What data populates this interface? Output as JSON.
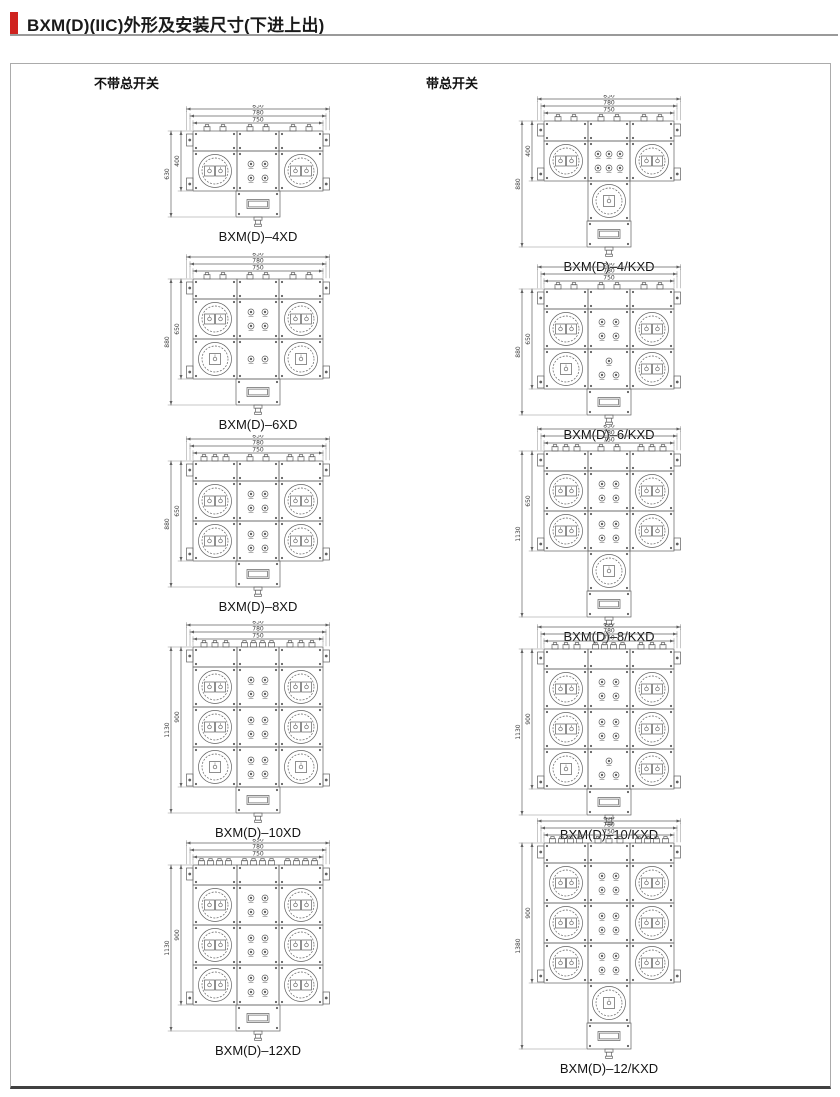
{
  "page": {
    "title": "BXM(D)(IIC)外形及安装尺寸(下进上出)",
    "accent_color": "#cf231f"
  },
  "sections": {
    "left_header": "不带总开关",
    "right_header": "带总开关"
  },
  "figures": [
    {
      "caption": "BXM(D)–4XD",
      "dimensions": {
        "top": [
          "830",
          "780",
          "750"
        ],
        "outer": "630",
        "inner": "400"
      },
      "drawing": {
        "rows": [
          {
            "left_sockets": 2,
            "indicators": 4,
            "right_sockets": 2
          }
        ],
        "has_main_switch": false,
        "glands": [
          2,
          2,
          2
        ]
      }
    },
    {
      "caption": "BXM(D)–6XD",
      "dimensions": {
        "top": [
          "830",
          "780",
          "750"
        ],
        "outer": "880",
        "inner": "650"
      },
      "drawing": {
        "rows": [
          {
            "left_sockets": 2,
            "indicators": 4,
            "right_sockets": 2
          },
          {
            "left_sockets": 1,
            "indicators": 2,
            "right_sockets": 1
          }
        ],
        "has_main_switch": false,
        "glands": [
          2,
          2,
          2
        ]
      }
    },
    {
      "caption": "BXM(D)–8XD",
      "dimensions": {
        "top": [
          "830",
          "780",
          "750"
        ],
        "outer": "880",
        "inner": "650"
      },
      "drawing": {
        "rows": [
          {
            "left_sockets": 2,
            "indicators": 4,
            "right_sockets": 2
          },
          {
            "left_sockets": 2,
            "indicators": 4,
            "right_sockets": 2
          }
        ],
        "has_main_switch": false,
        "glands": [
          3,
          2,
          3
        ]
      }
    },
    {
      "caption": "BXM(D)–10XD",
      "dimensions": {
        "top": [
          "830",
          "780",
          "750"
        ],
        "outer": "1130",
        "inner": "900"
      },
      "drawing": {
        "rows": [
          {
            "left_sockets": 2,
            "indicators": 4,
            "right_sockets": 2
          },
          {
            "left_sockets": 2,
            "indicators": 4,
            "right_sockets": 2
          },
          {
            "left_sockets": 1,
            "indicators": 4,
            "right_sockets": 1
          }
        ],
        "has_main_switch": false,
        "glands": [
          3,
          4,
          3
        ]
      }
    },
    {
      "caption": "BXM(D)–12XD",
      "dimensions": {
        "top": [
          "830",
          "780",
          "750"
        ],
        "outer": "1130",
        "inner": "900"
      },
      "drawing": {
        "rows": [
          {
            "left_sockets": 2,
            "indicators": 4,
            "right_sockets": 2
          },
          {
            "left_sockets": 2,
            "indicators": 4,
            "right_sockets": 2
          },
          {
            "left_sockets": 2,
            "indicators": 4,
            "right_sockets": 2
          }
        ],
        "has_main_switch": false,
        "glands": [
          4,
          4,
          4
        ]
      }
    },
    {
      "caption": "BXM(D)–4/KXD",
      "dimensions": {
        "top": [
          "830",
          "780",
          "750"
        ],
        "outer": "880",
        "inner": "400"
      },
      "drawing": {
        "rows": [
          {
            "left_sockets": 2,
            "indicators": 6,
            "right_sockets": 2
          }
        ],
        "has_main_switch": true,
        "glands": [
          2,
          2,
          2
        ]
      }
    },
    {
      "caption": "BXM(D)–6/KXD",
      "dimensions": {
        "top": [
          "830",
          "780",
          "750"
        ],
        "outer": "880",
        "inner": "650"
      },
      "drawing": {
        "rows": [
          {
            "left_sockets": 2,
            "indicators": 4,
            "right_sockets": 2
          },
          {
            "left_sockets": 1,
            "indicators": 3,
            "right_sockets": 2
          }
        ],
        "has_main_switch": false,
        "glands": [
          2,
          2,
          2
        ]
      }
    },
    {
      "caption": "BXM(D)–8/KXD",
      "dimensions": {
        "top": [
          "830",
          "780",
          "750"
        ],
        "outer": "1130",
        "inner": "650"
      },
      "drawing": {
        "rows": [
          {
            "left_sockets": 2,
            "indicators": 4,
            "right_sockets": 2
          },
          {
            "left_sockets": 2,
            "indicators": 4,
            "right_sockets": 2
          }
        ],
        "has_main_switch": true,
        "glands": [
          3,
          2,
          3
        ]
      }
    },
    {
      "caption": "BXM(D)–10/KXD",
      "dimensions": {
        "top": [
          "830",
          "780",
          "750"
        ],
        "outer": "1130",
        "inner": "900"
      },
      "drawing": {
        "rows": [
          {
            "left_sockets": 2,
            "indicators": 4,
            "right_sockets": 2
          },
          {
            "left_sockets": 2,
            "indicators": 4,
            "right_sockets": 2
          },
          {
            "left_sockets": 1,
            "indicators": 3,
            "right_sockets": 2
          }
        ],
        "has_main_switch": false,
        "glands": [
          3,
          4,
          3
        ]
      }
    },
    {
      "caption": "BXM(D)–12/KXD",
      "dimensions": {
        "top": [
          "830",
          "780",
          "750"
        ],
        "outer": "1380",
        "inner": "900"
      },
      "drawing": {
        "rows": [
          {
            "left_sockets": 2,
            "indicators": 4,
            "right_sockets": 2
          },
          {
            "left_sockets": 2,
            "indicators": 4,
            "right_sockets": 2
          },
          {
            "left_sockets": 2,
            "indicators": 4,
            "right_sockets": 2
          }
        ],
        "has_main_switch": true,
        "glands": [
          4,
          3,
          4
        ]
      }
    }
  ]
}
